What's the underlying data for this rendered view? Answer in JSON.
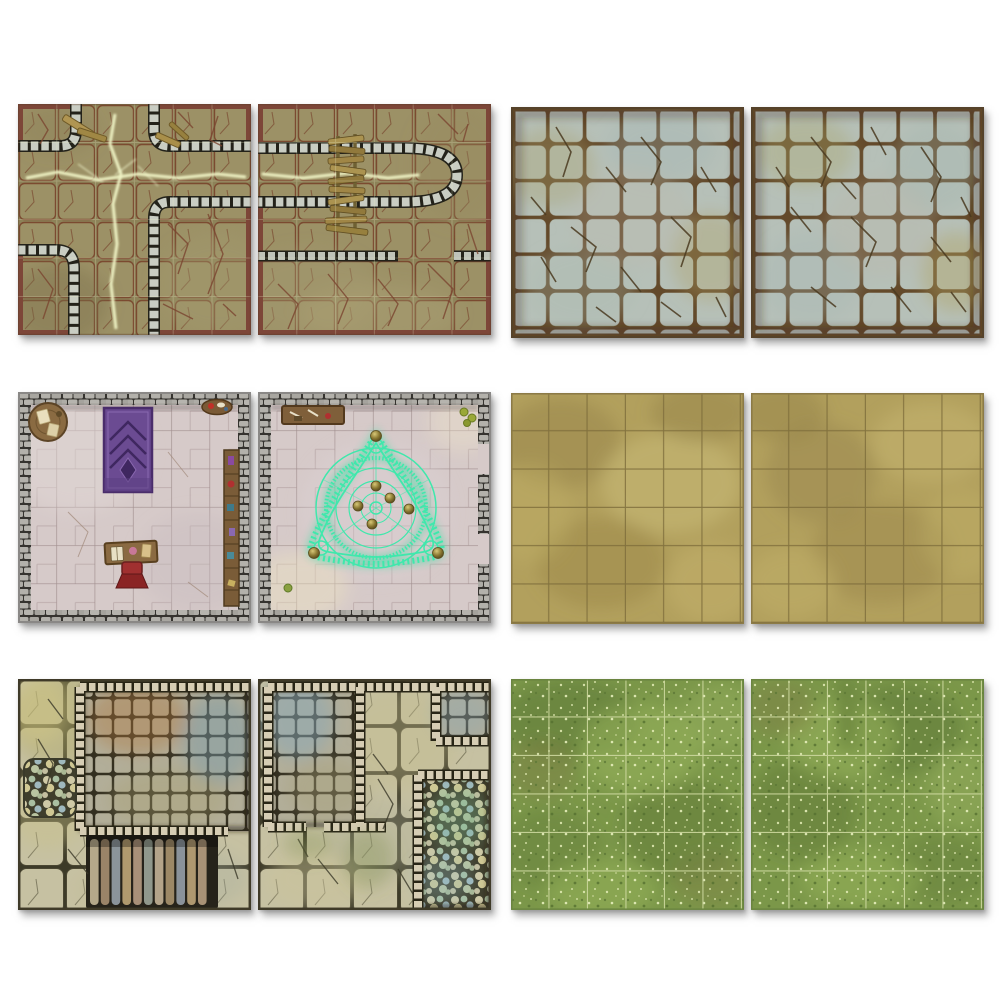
{
  "page": {
    "background": "#ffffff",
    "description": "Product grid of six two-tile dungeon and terrain battle-map tile sets, arranged in three rows and two columns",
    "visible_text": []
  },
  "layout": {
    "rows": 3,
    "cols": 2,
    "tiles_per_set": 2,
    "grid_per_tile": "6x6"
  },
  "palette": {
    "background": "#ffffff",
    "stream_glow": "#eff3c4",
    "stream_dark": "#2f351c",
    "flagstone_olive": "#9c9166",
    "cobble_gray": "#c9cdc3",
    "tile_edge_maroon": "#7d4638",
    "pale_stone": "#b6c0b8",
    "grout_brown": "#63492a",
    "floor_pink": "#d6cac9",
    "wall_gray": "#b3b1ab",
    "rug_purple": "#6b4b92",
    "ritual_glyph": "#3fe8ac",
    "orb_gold": "#8a7832",
    "wood_brown": "#8a6a42",
    "chair_red": "#a03030",
    "sand_base": "#b2a05d",
    "sand_grid": "#7c6b3a",
    "slab_sage": "#c6c1a2",
    "wall_cream": "#d6cdb4",
    "grass_base": "#7b9749",
    "grass_grid": "#ccd79e",
    "bridge_wood": "#a08646",
    "shadow": "#9a9a9a"
  },
  "pairs": [
    {
      "name": "Dungeon stream corridor tile set",
      "position": "row 1 left",
      "tiles": [
        "glowing stream crossroads with cobbled banks and olive flagstone corners",
        "glowing stream dead-end with rickety wooden plank bridge and cobbled wall row"
      ]
    },
    {
      "name": "Cracked flagstone floor tile set",
      "position": "row 1 right",
      "tiles": [
        "pale blue-green cracked flagstones in 6x6 grid with brown grout",
        "pale blue-green cracked flagstones in 6x6 grid with brown grout"
      ]
    },
    {
      "name": "Study and ritual chamber tile set",
      "position": "row 2 left",
      "tiles": [
        "stone-walled study with purple rug, round table, oval table, desk, red chair and bookshelf",
        "stone-walled ritual chamber with glowing mint-green triangular summoning circle and brass orbs"
      ]
    },
    {
      "name": "Sand floor tile set",
      "position": "row 2 right",
      "tiles": [
        "mottled tan stone floor with 6x6 grid",
        "mottled tan stone floor with 6x6 grid"
      ]
    },
    {
      "name": "Dungeon chambers tile set",
      "position": "row 3 left",
      "tiles": [
        "chambers with small-tiled room, descending staircase and pebble mosaic patch",
        "chambers with tiled rooms, corridors and pebble mosaic room"
      ]
    },
    {
      "name": "Grass field tile set",
      "position": "row 3 right",
      "tiles": [
        "mottled green grass with 6x6 grid",
        "mottled green grass with 6x6 grid"
      ]
    }
  ]
}
